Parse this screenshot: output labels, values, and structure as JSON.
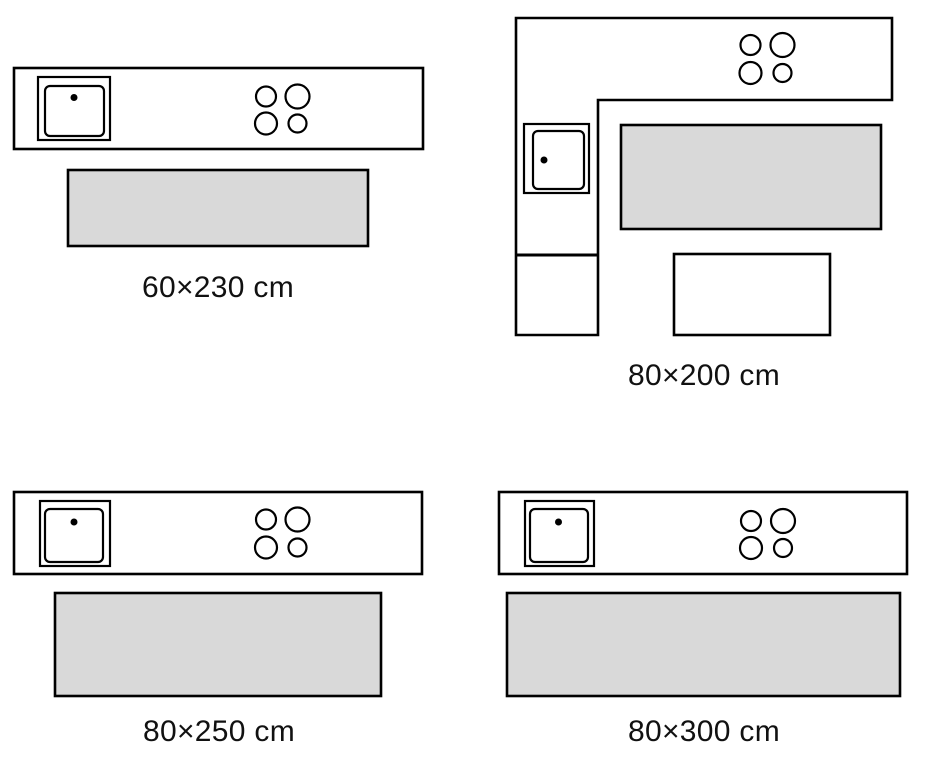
{
  "colors": {
    "background": "#ffffff",
    "outline": "#000000",
    "rug_fill": "#d9d9d9",
    "text": "#111111"
  },
  "panels": [
    {
      "position": "top-left",
      "label": "60×230 cm",
      "rug_width_cm": 60,
      "rug_length_cm": 230,
      "kitchen_type": "straight counter"
    },
    {
      "position": "top-right",
      "label": "80×200 cm",
      "rug_width_cm": 80,
      "rug_length_cm": 200,
      "kitchen_type": "l-shaped counter"
    },
    {
      "position": "bottom-left",
      "label": "80×250 cm",
      "rug_width_cm": 80,
      "rug_length_cm": 250,
      "kitchen_type": "straight counter"
    },
    {
      "position": "bottom-right",
      "label": "80×300 cm",
      "rug_width_cm": 80,
      "rug_length_cm": 300,
      "kitchen_type": "straight counter"
    }
  ]
}
